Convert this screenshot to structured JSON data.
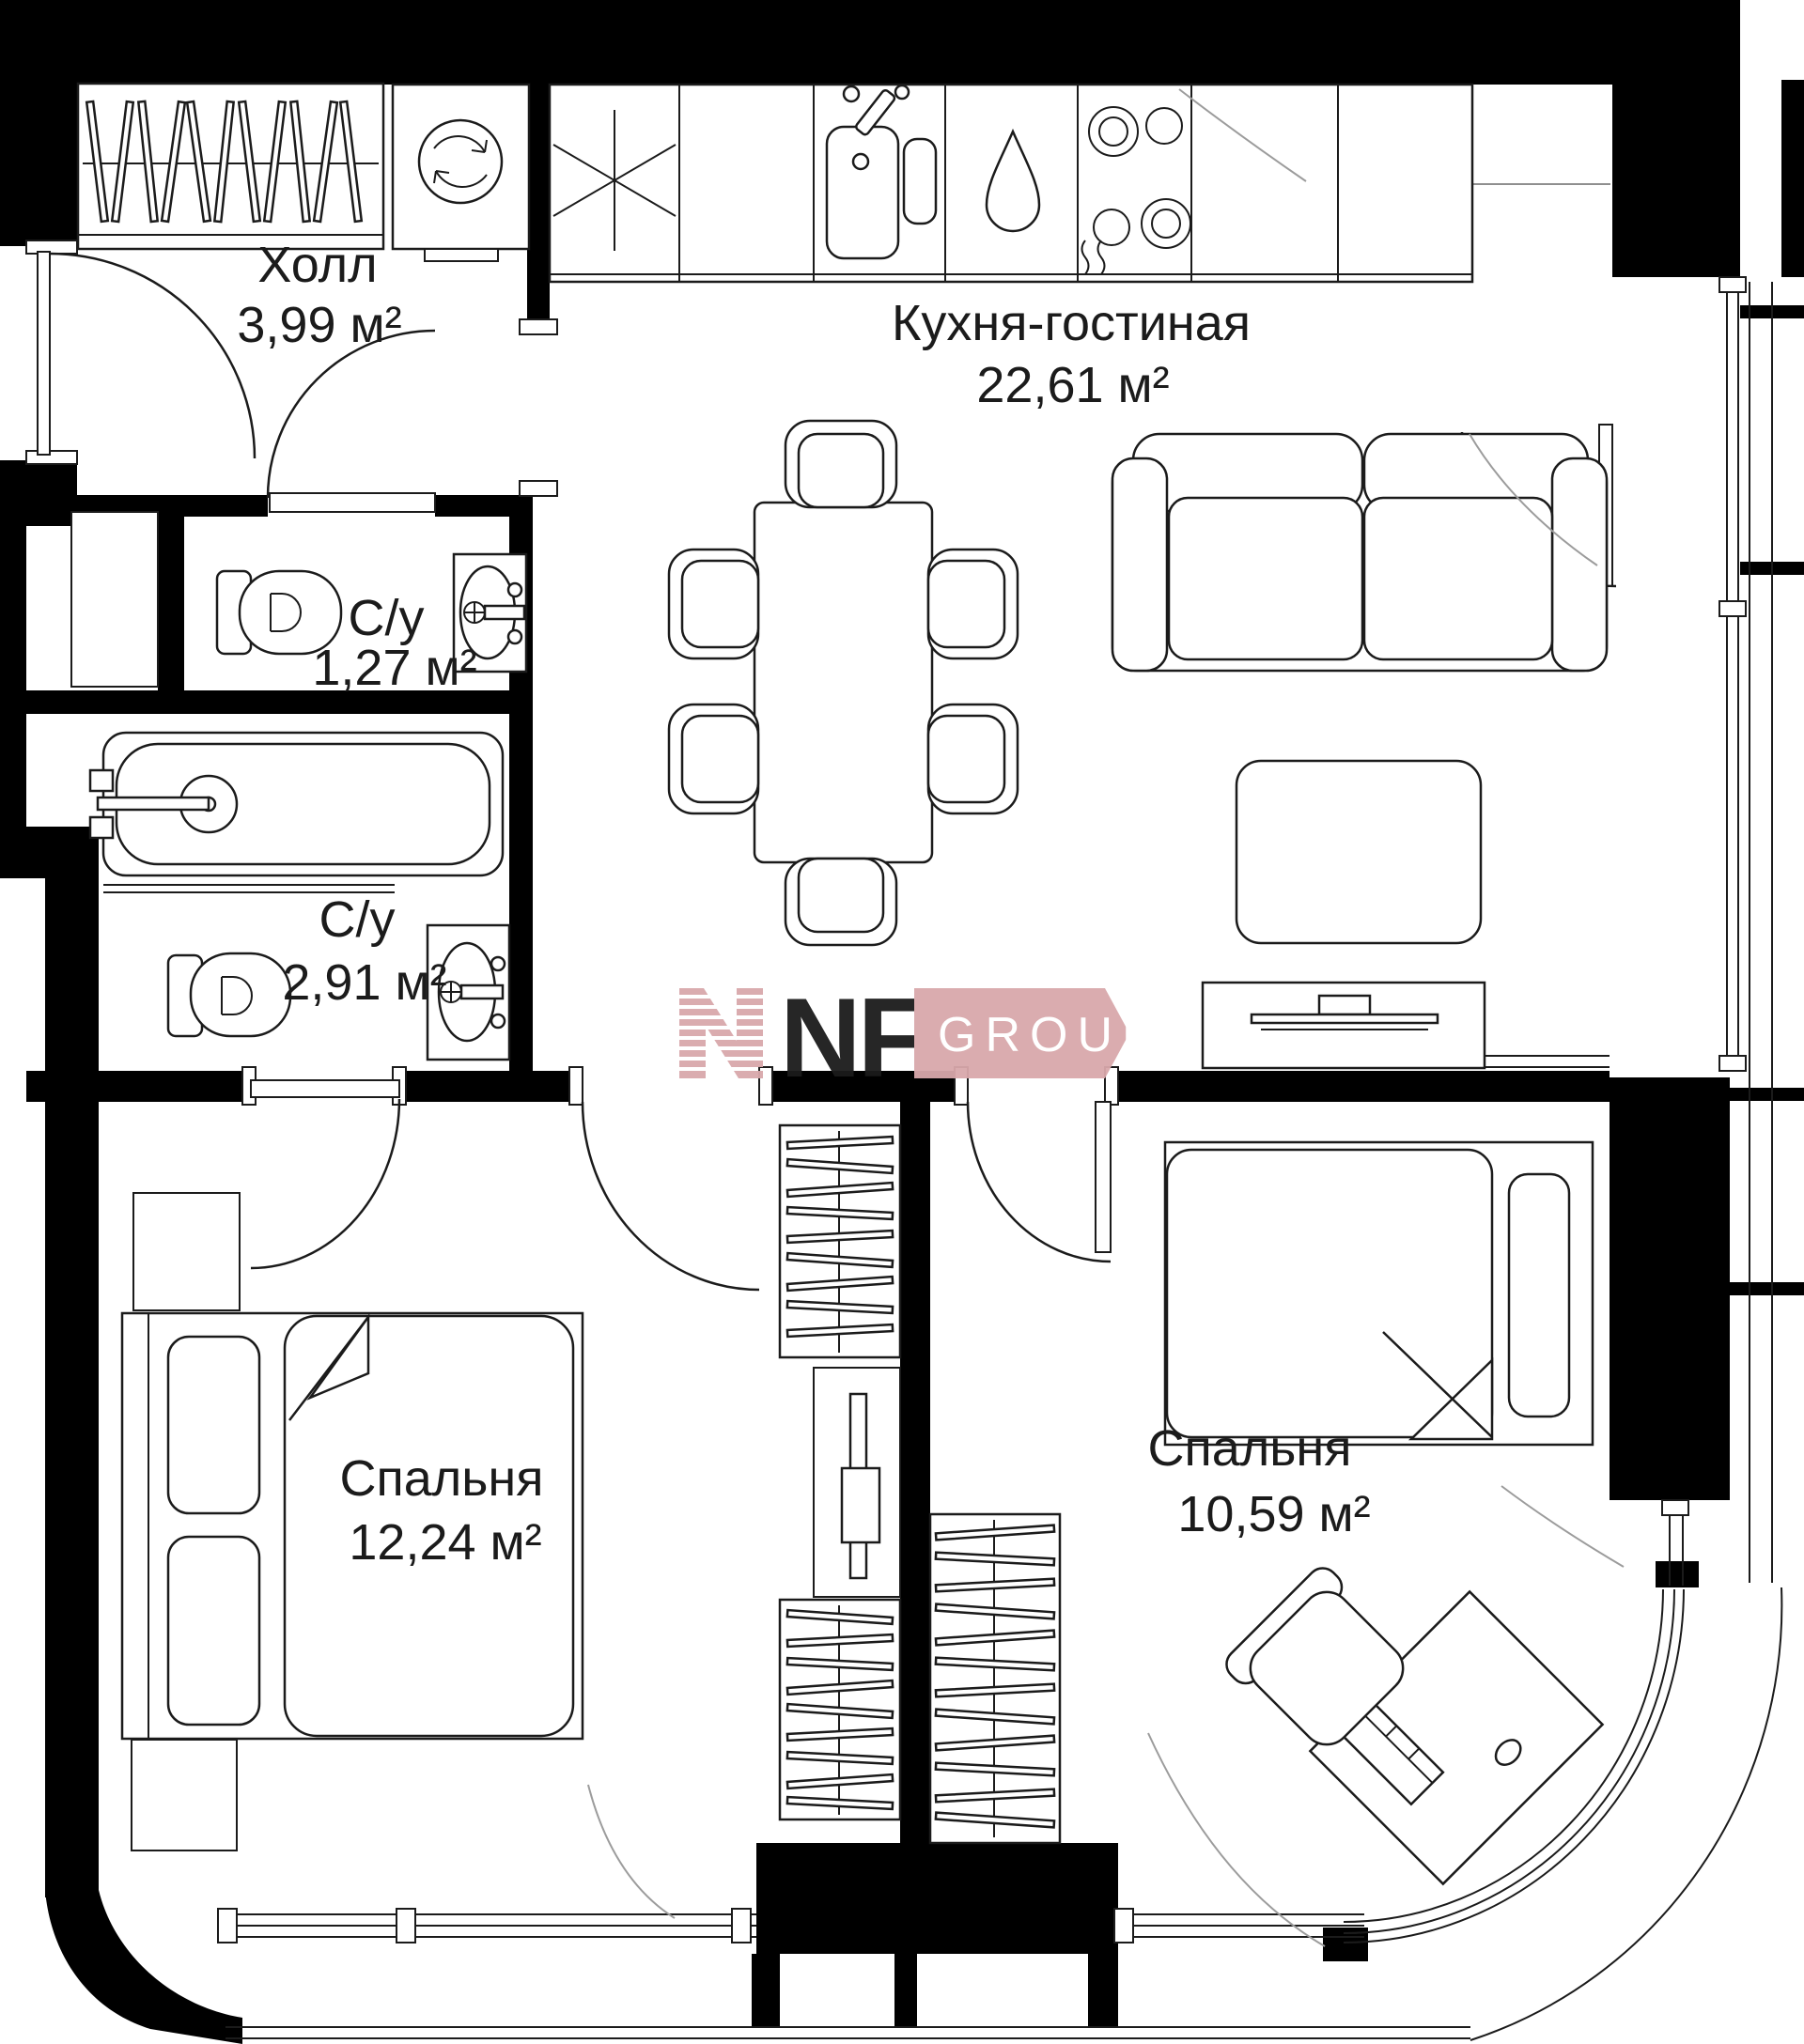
{
  "rooms": [
    {
      "name": "Холл",
      "area": "3,99 м²"
    },
    {
      "name": "Кухня-гостиная",
      "area": "22,61 м²"
    },
    {
      "name": "С/у",
      "area": "1,27 м²"
    },
    {
      "name": "С/у",
      "area": "2,91 м²"
    },
    {
      "name": "Спальня",
      "area": "12,24 м²"
    },
    {
      "name": "Спальня",
      "area": "10,59 м²"
    }
  ],
  "logo": {
    "letters": "NF",
    "word": "GROUP"
  },
  "colors": {
    "wall": "#000000",
    "line": "#1b1b1b",
    "logo_pink": "#d9a8ab",
    "faint": "#9c9c9c"
  }
}
